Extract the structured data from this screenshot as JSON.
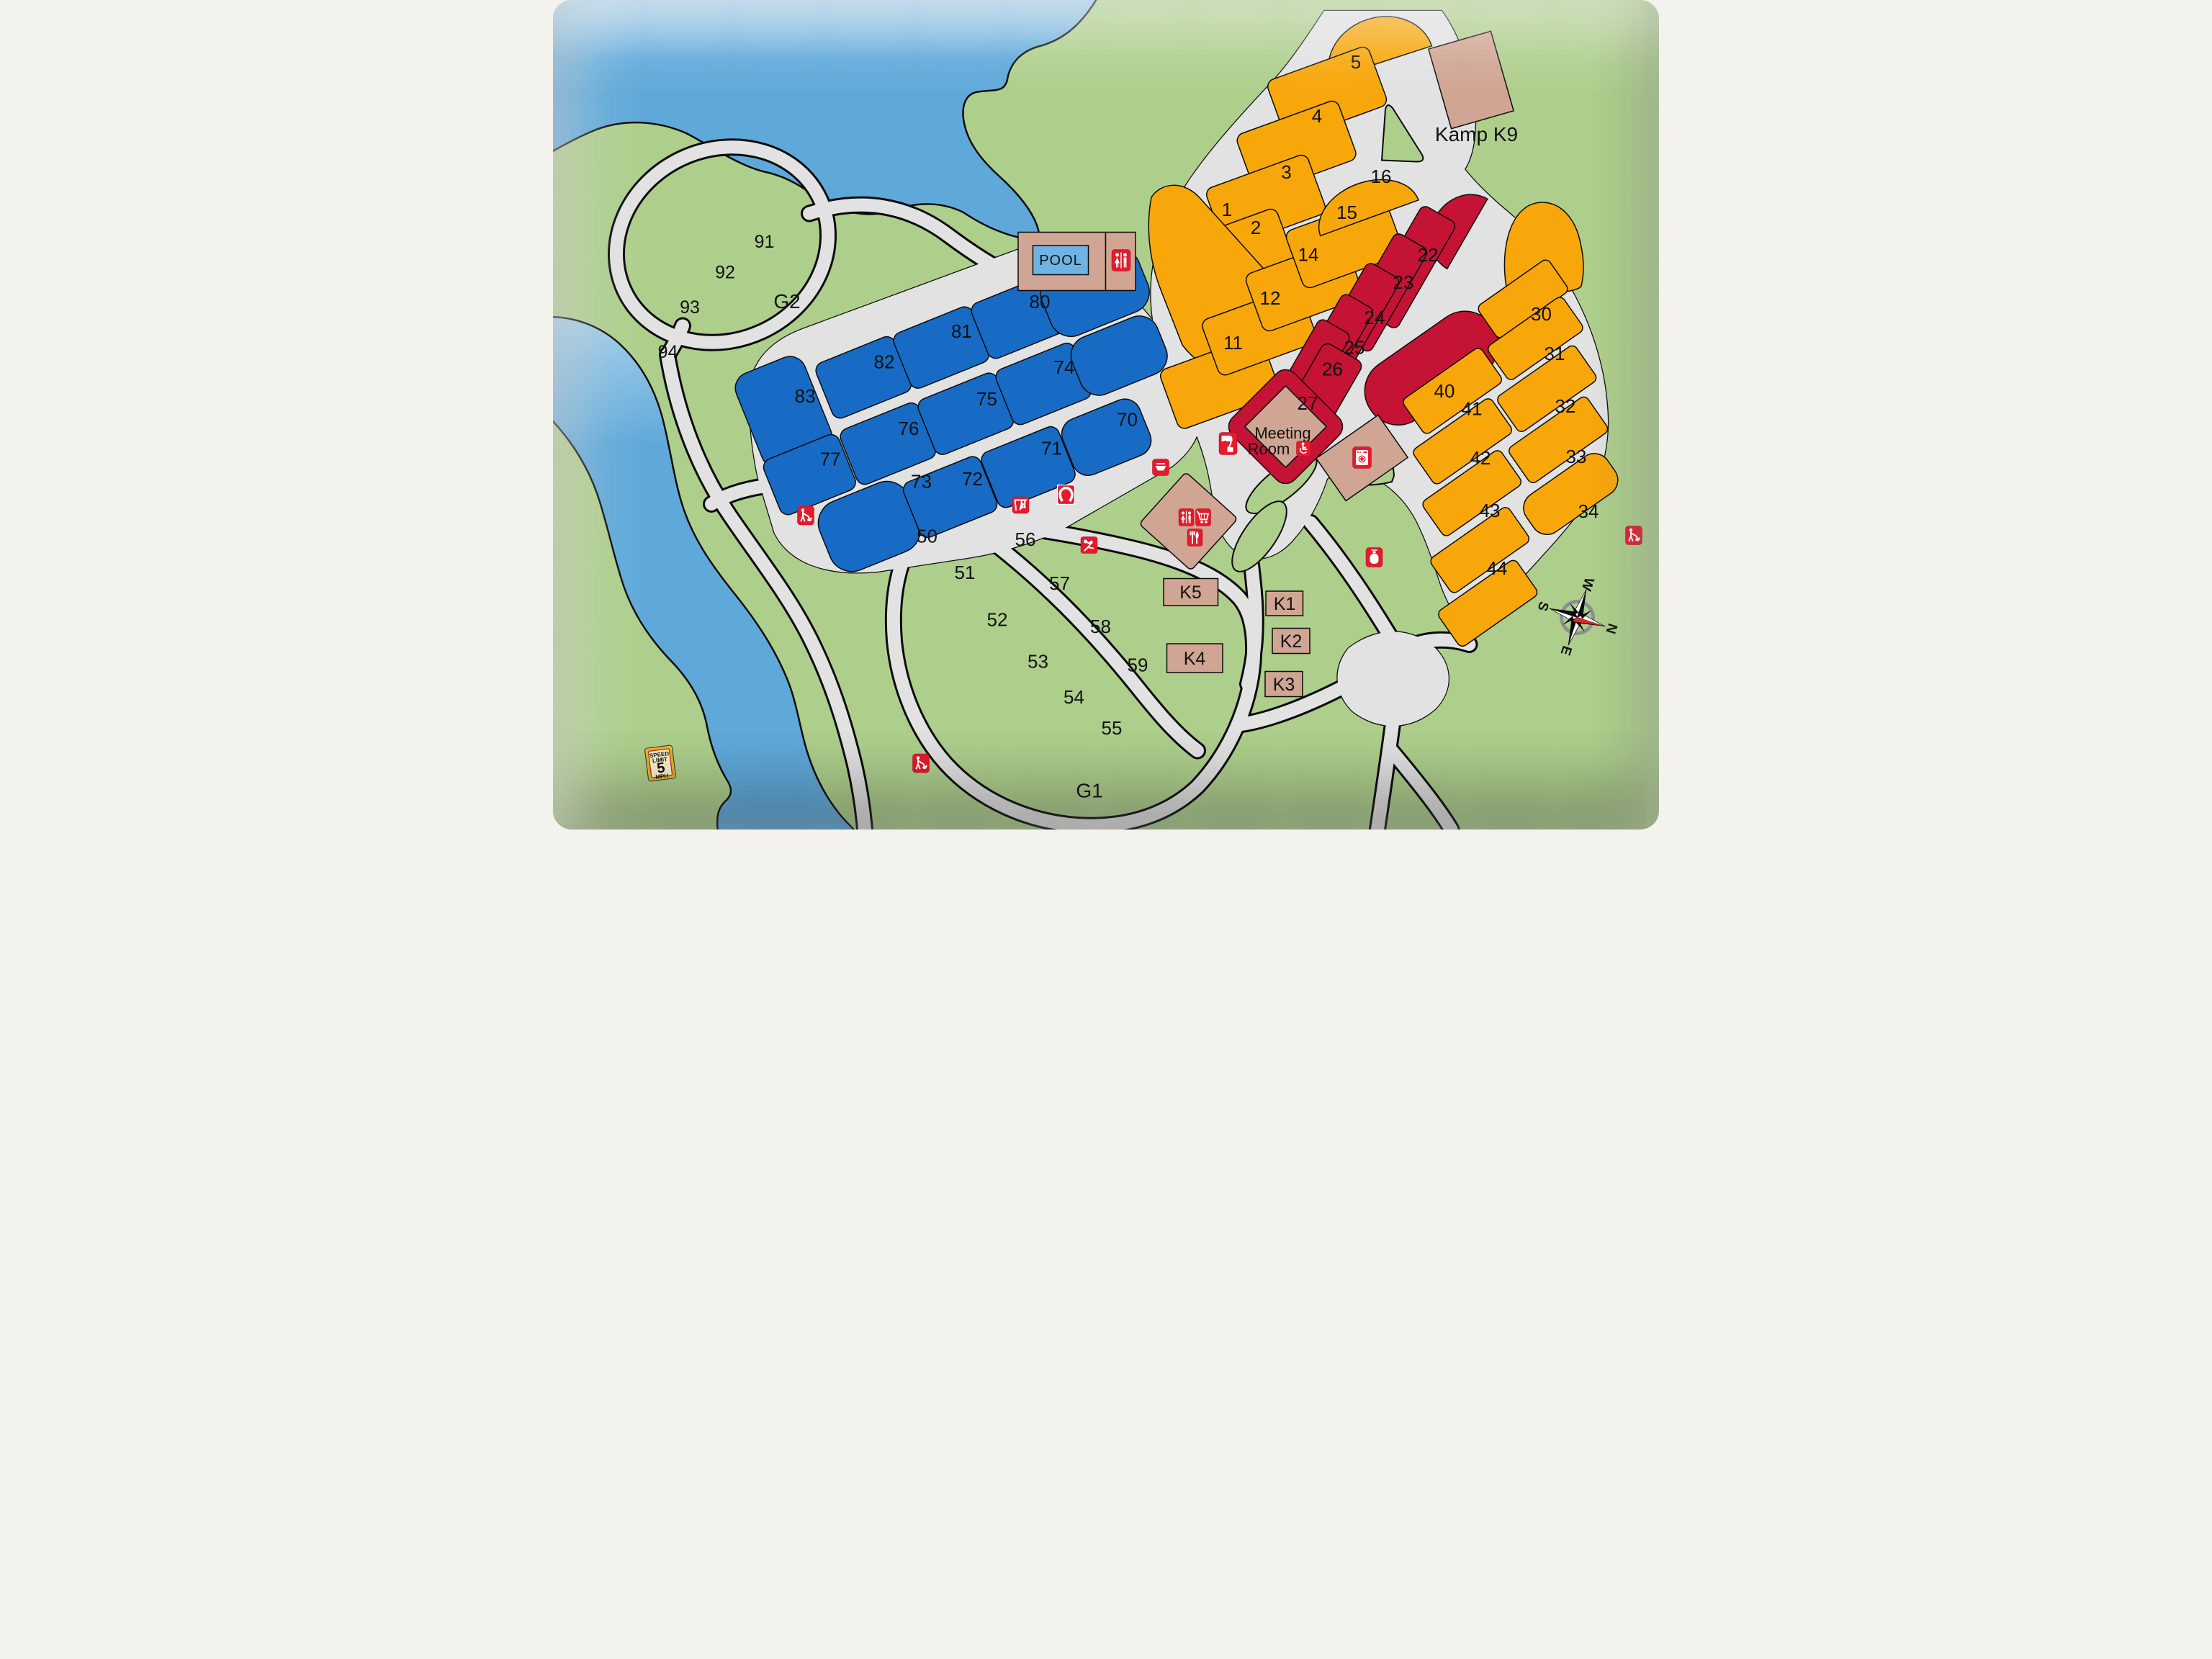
{
  "map_title": "Campground site map",
  "palette": {
    "water": "#5fa9da",
    "water_light": "#a3cde9",
    "land": "#aecf8c",
    "road": "#e2e2e2",
    "blue_site": "#176bc4",
    "orange_site": "#f8a70b",
    "red_site": "#c41334",
    "building_tan": "#d1a593",
    "icon_red": "#e31b2d",
    "compass_navy": "#1d2e6f",
    "sign_cream": "#fdf3cf"
  },
  "sites": {
    "s1": "1",
    "s2": "2",
    "s3": "3",
    "s4": "4",
    "s5": "5",
    "s11": "11",
    "s12": "12",
    "s14": "14",
    "s15": "15",
    "s16": "16",
    "s22": "22",
    "s23": "23",
    "s24": "24",
    "s25": "25",
    "s26": "26",
    "s27": "27",
    "s30": "30",
    "s31": "31",
    "s32": "32",
    "s33": "33",
    "s34": "34",
    "s40": "40",
    "s41": "41",
    "s42": "42",
    "s43": "43",
    "s44": "44",
    "s50": "50",
    "s51": "51",
    "s52": "52",
    "s53": "53",
    "s54": "54",
    "s55": "55",
    "s56": "56",
    "s57": "57",
    "s58": "58",
    "s59": "59",
    "s70": "70",
    "s71": "71",
    "s72": "72",
    "s73": "73",
    "s74": "74",
    "s75": "75",
    "s76": "76",
    "s77": "77",
    "s80": "80",
    "s81": "81",
    "s82": "82",
    "s83": "83",
    "s91": "91",
    "s92": "92",
    "s93": "93",
    "s94": "94"
  },
  "areas": {
    "g1": "G1",
    "g2": "G2"
  },
  "cabins": {
    "k1": "K1",
    "k2": "K2",
    "k3": "K3",
    "k4": "K4",
    "k5": "K5"
  },
  "buildings": {
    "kamp_k9": "Kamp K9",
    "pool": "POOL",
    "meeting_line1": "Meeting",
    "meeting_line2": "Room"
  },
  "speed_sign": {
    "line1": "SPEED",
    "line2": "LIMIT",
    "value": "5",
    "unit": "MPH"
  },
  "compass": {
    "n": "N",
    "e": "E",
    "s": "S",
    "w": "W"
  },
  "icons": [
    "restroom-icon",
    "dump-station-icon",
    "boat-icon",
    "swing-icon",
    "horseshoe-icon",
    "volleyball-icon",
    "shopping-cart-icon",
    "food-icon",
    "laundry-icon",
    "propane-icon",
    "dog-walk-icon",
    "handicap-icon"
  ]
}
